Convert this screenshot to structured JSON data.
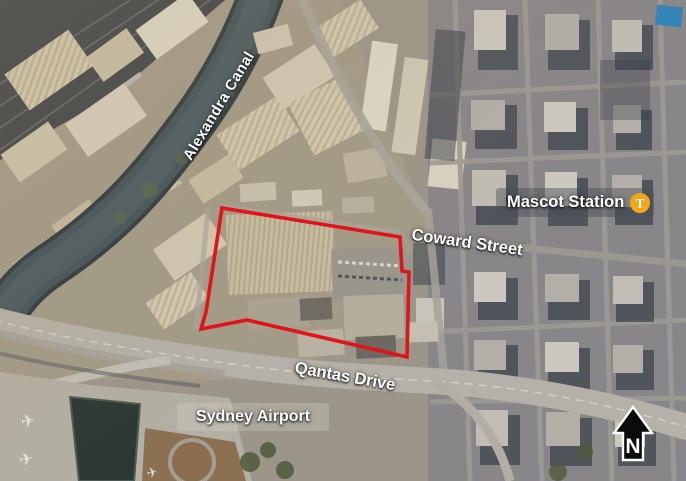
{
  "figure": {
    "type": "annotated-aerial-map",
    "labels": {
      "alexandra_canal": "Alexandra Canal",
      "mascot_station": "Mascot Station",
      "coward_street": "Coward Street",
      "qantas_drive": "Qantas Drive",
      "sydney_airport": "Sydney Airport"
    },
    "station_badge": {
      "letter": "T",
      "color": "#F0A61C"
    },
    "compass": {
      "north_label": "N"
    },
    "site_boundary": {
      "color": "#E01419"
    }
  }
}
